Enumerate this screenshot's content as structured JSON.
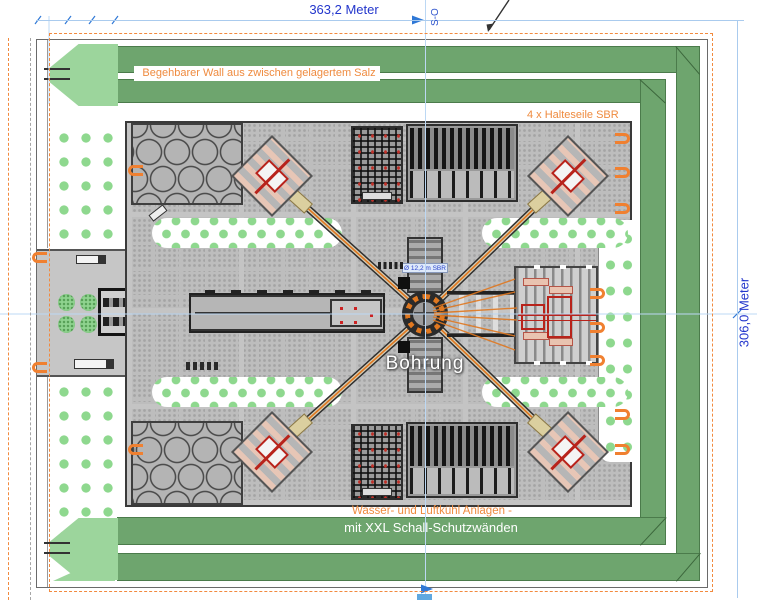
{
  "diagram": {
    "type": "drill-site plan view",
    "dimensions": {
      "width_label": "363,2 Meter",
      "height_label": "306,0 Meter"
    },
    "section_label": "S-O",
    "annotations": {
      "wall_label": "Begehbarer Wall aus zwischen gelagertem Salz",
      "cable_label": "4 x Halteseile SBR",
      "borehole_label": "Bohrung",
      "borehole_diameter_label": "Ø 12,2 m SBR",
      "cooling_label_line1": "Wasser- und Luftkühl Anlagen -",
      "cooling_label_line2": "mit XXL Schall-Schutzwänden"
    },
    "colors": {
      "dimension_text_blue": "#2336cc",
      "dimension_line_blue": "#aacbee",
      "annotation_orange": "#ef8b3f",
      "dashed_border_orange": "#f28a3e",
      "wall_green": "#6ea56e",
      "arrow_light_green": "#9cd59c",
      "tree_dot_green": "#8ed88e",
      "pad_gray": "#bdbdbd",
      "equipment_red": "#b8231b",
      "cable_orange": "#e07820"
    },
    "icons": {
      "entrance_arrow": "left-arrow",
      "cable_anchor_bracket": "c-bracket",
      "dimension_arrowhead": "triangle-right",
      "leader_arrow": "diagonal-arrow"
    }
  }
}
